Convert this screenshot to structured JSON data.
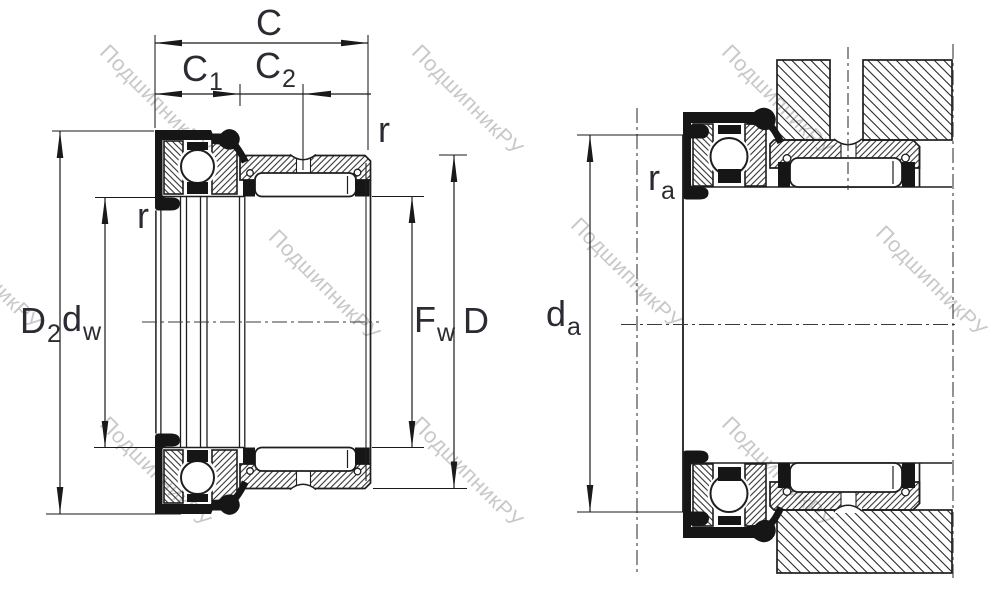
{
  "colors": {
    "line": "#1e1e1e",
    "solid_fill": "#161616",
    "label_text": "#2b2b33",
    "watermark": "#c8c8c8",
    "background": "#ffffff"
  },
  "watermark": {
    "text": "ПодшипникРУ"
  },
  "labels": {
    "C": {
      "base": "C",
      "sub": ""
    },
    "C1": {
      "base": "C",
      "sub": "1"
    },
    "C2": {
      "base": "C",
      "sub": "2"
    },
    "r_left": {
      "base": "r",
      "sub": ""
    },
    "r_right": {
      "base": "r",
      "sub": ""
    },
    "D2": {
      "base": "D",
      "sub": "2"
    },
    "dw": {
      "base": "d",
      "sub": "w"
    },
    "Fw": {
      "base": "F",
      "sub": "w"
    },
    "D": {
      "base": "D",
      "sub": ""
    },
    "da": {
      "base": "d",
      "sub": "a"
    },
    "ra": {
      "base": "r",
      "sub": "a"
    }
  }
}
